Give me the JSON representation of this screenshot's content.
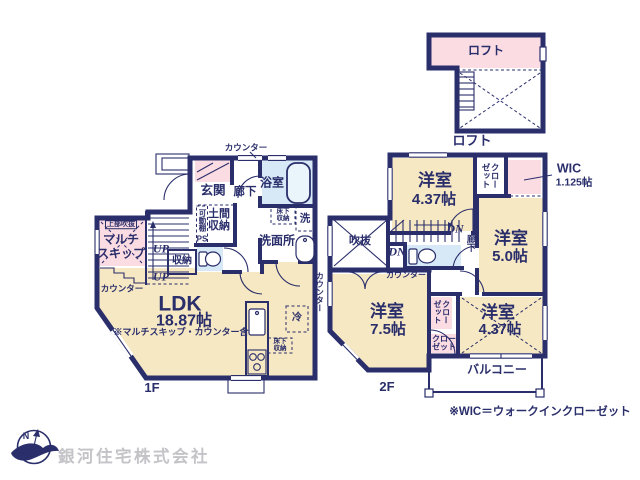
{
  "colors": {
    "wall": "#2a2e6b",
    "beige": "#f6e8c3",
    "pink": "#fbdce3",
    "blue": "#d7e9f6",
    "bluefix": "#eaf4fb",
    "gray": "#c3c3c8",
    "bg": "#ffffff"
  },
  "loft": {
    "room_label": "ロフト",
    "floor_label": "ロフト"
  },
  "f1": {
    "floor_label": "1F",
    "ldk": {
      "name": "LDK",
      "size": "18.87帖",
      "note": "※マルチスキップ・カウンター含"
    },
    "genkan": "玄関",
    "rouka": "廊下",
    "bath": "浴室",
    "senmenjo": "洗面所",
    "laundry": "洗",
    "yukashita_1": "床下収納",
    "yukashita_2": "床下収納",
    "doma": "土間収納",
    "kadoudana": "可動棚",
    "ps": "PS",
    "joubu": "上部吹抜",
    "multi_line1": "マルチ",
    "multi_line2": "スキップ",
    "shunou": "収納",
    "rei": "冷",
    "counter_top": "カウンター",
    "counter_left": "カウンター",
    "counter_right": "カウンター",
    "up_1": "UP",
    "up_2": "UP"
  },
  "f2": {
    "floor_label": "2F",
    "room_nw": {
      "name": "洋室",
      "size": "4.37帖"
    },
    "room_e": {
      "name": "洋室",
      "size": "5.0帖"
    },
    "room_s": {
      "name": "洋室",
      "size": "7.5帖"
    },
    "room_se": {
      "name": "洋室",
      "size": "4.37帖"
    },
    "wic": {
      "name": "WIC",
      "size": "1.125帖"
    },
    "closet_n": "クローゼット",
    "closet_mid": "クローゼット",
    "closet_s_line1": "クロー",
    "closet_s_line2": "ゼット",
    "fukinuke": "吹抜",
    "rouka": "廊下",
    "counter": "カウンター",
    "balcony": "バルコニー",
    "dn_1": "DN",
    "dn_2": "DN"
  },
  "footer": {
    "wic_note": "※WIC＝ウォークインクローゼット",
    "company": "銀河住宅株式会社",
    "compass_n": "N"
  }
}
